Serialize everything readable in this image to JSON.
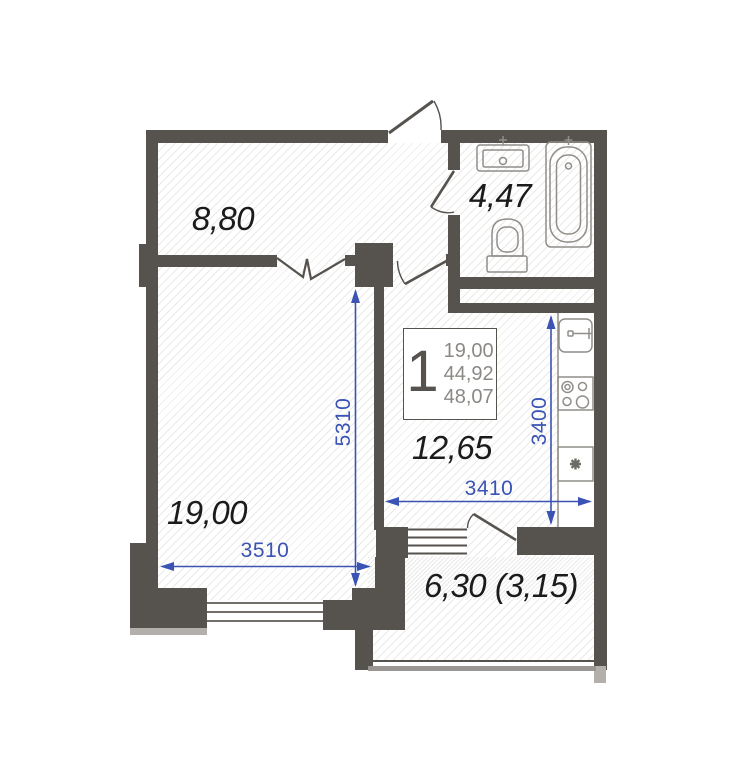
{
  "badge": {
    "rooms": "1",
    "living_area": "19,00",
    "area": "44,92",
    "total_area": "48,07"
  },
  "rooms": {
    "hallway": {
      "label": "8,80"
    },
    "bathroom": {
      "label": "4,47"
    },
    "kitchen": {
      "label": "12,65"
    },
    "living": {
      "label": "19,00"
    },
    "balcony": {
      "label": "6,30 (3,15)"
    }
  },
  "dimensions": {
    "living_width": "3510",
    "living_depth": "5310",
    "kitchen_width": "3410",
    "kitchen_depth": "3400"
  },
  "colors": {
    "wall": "#56524e",
    "dim": "#3a53b4",
    "label": "#1b1b1b",
    "fixture": "#918d89",
    "shadow": "#b3afab"
  }
}
